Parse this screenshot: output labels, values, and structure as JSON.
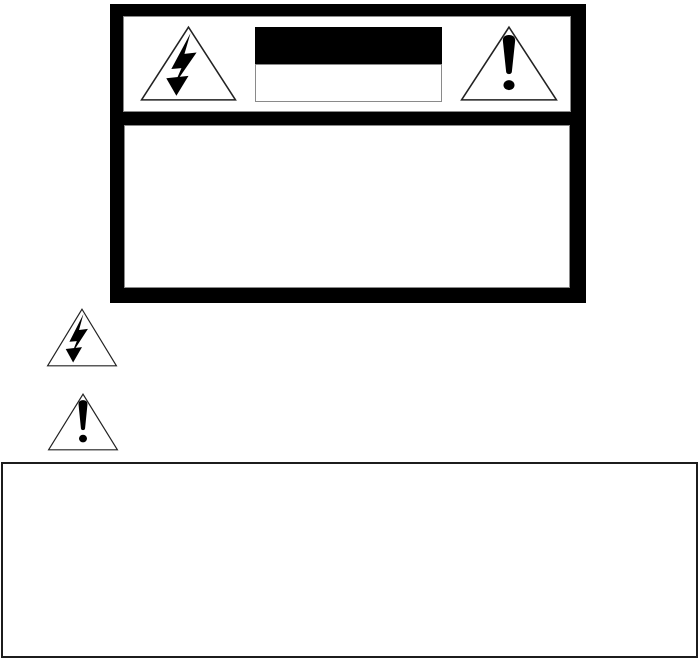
{
  "document": {
    "type": "safety-warning-page",
    "background": "#ffffff"
  },
  "colors": {
    "ink": "#000000",
    "paper": "#ffffff",
    "thin_border": "#8a8a8a",
    "notice_border": "#1c1c1c",
    "panel_frame": "#000000"
  },
  "warning_panel": {
    "header": {
      "left_icon": "high-voltage-lightning-triangle-icon",
      "right_icon": "alert-exclamation-triangle-icon",
      "label_block": {
        "title_band": {
          "background": "#000000",
          "text": ""
        },
        "subtitle_band": {
          "background": "#ffffff",
          "text": ""
        }
      }
    },
    "body": {
      "text": ""
    }
  },
  "inline_symbols": [
    {
      "icon": "high-voltage-lightning-triangle-icon"
    },
    {
      "icon": "alert-exclamation-triangle-icon"
    }
  ],
  "notice_box": {
    "text": ""
  }
}
